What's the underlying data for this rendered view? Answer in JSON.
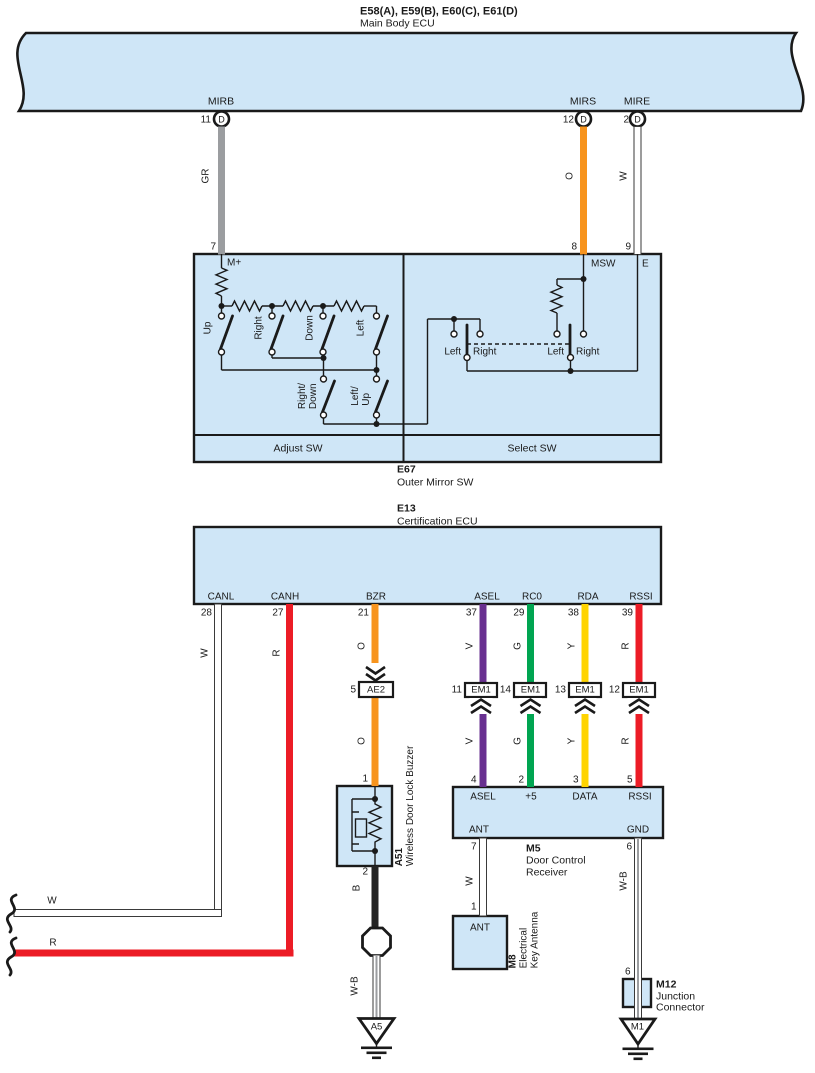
{
  "colors": {
    "blue": "#cfe6f7",
    "line": "#1a1a1a",
    "orange": "#f7941e",
    "gray": "#9b9da0",
    "red": "#ec1c26",
    "green": "#00a551",
    "yellow": "#ffd400",
    "purple": "#683090",
    "black": "#232323"
  },
  "header": {
    "codes": "E58(A), E59(B), E60(C), E61(D)",
    "name": "Main Body ECU"
  },
  "top_pins": {
    "mirb": {
      "label": "MIRB",
      "num": "11",
      "conn": "D",
      "wire": "GR"
    },
    "mirs": {
      "label": "MIRS",
      "num": "12",
      "conn": "D",
      "wire": "O"
    },
    "mire": {
      "label": "MIRE",
      "num": "2",
      "conn": "D",
      "wire": "W"
    }
  },
  "e67": {
    "id": "E67",
    "name": "Outer Mirror SW",
    "pin7": "7",
    "pin8": "8",
    "pin9": "9",
    "mplus": "M+",
    "msw": "MSW",
    "e": "E",
    "adjust": "Adjust SW",
    "select": "Select SW",
    "up": "Up",
    "right": "Right",
    "down": "Down",
    "left": "Left",
    "rd1": "Right/",
    "rd2": "Down",
    "lu1": "Left/",
    "lu2": "Up",
    "s1l": "Left",
    "s1r": "Right",
    "s2l": "Left",
    "s2r": "Right"
  },
  "e13": {
    "id": "E13",
    "name": "Certification ECU",
    "canl": {
      "label": "CANL",
      "num": "28",
      "wire": "W"
    },
    "canh": {
      "label": "CANH",
      "num": "27",
      "wire": "R"
    },
    "bzr": {
      "label": "BZR",
      "num": "21",
      "wire": "O",
      "wire2": "O"
    },
    "asel": {
      "label": "ASEL",
      "num": "37",
      "wire": "V",
      "wire2": "V"
    },
    "rc0": {
      "label": "RC0",
      "num": "29",
      "wire": "G",
      "wire2": "G"
    },
    "rda": {
      "label": "RDA",
      "num": "38",
      "wire": "Y",
      "wire2": "Y"
    },
    "rssi": {
      "label": "RSSI",
      "num": "39",
      "wire": "R",
      "wire2": "R"
    }
  },
  "conn": {
    "ae2": {
      "num": "5",
      "label": "AE2"
    },
    "em1a": {
      "num": "11",
      "label": "EM1"
    },
    "em1b": {
      "num": "14",
      "label": "EM1"
    },
    "em1c": {
      "num": "13",
      "label": "EM1"
    },
    "em1d": {
      "num": "12",
      "label": "EM1"
    }
  },
  "a51": {
    "id": "A51",
    "name": "Wireless Door Lock Buzzer",
    "pin1": "1",
    "pin2": "2",
    "wire_b": "B",
    "wire_wb": "W-B",
    "gnd": "A5"
  },
  "m5": {
    "id": "M5",
    "name1": "Door Control",
    "name2": "Receiver",
    "asel": "ASEL",
    "plus5": "+5",
    "data": "DATA",
    "rssi": "RSSI",
    "ant": "ANT",
    "gnd": "GND",
    "n4": "4",
    "n2": "2",
    "n3": "3",
    "n5": "5",
    "n7": "7",
    "n6": "6",
    "wire_w": "W",
    "wire_wb": "W-B"
  },
  "m8": {
    "id": "M8",
    "name1": "Electrical",
    "name2": "Key Antenna",
    "ant": "ANT",
    "pin": "1"
  },
  "m12": {
    "id": "M12",
    "name1": "Junction",
    "name2": "Connector",
    "pin": "6",
    "gnd": "M1"
  },
  "exits": {
    "w": "W",
    "r": "R"
  }
}
